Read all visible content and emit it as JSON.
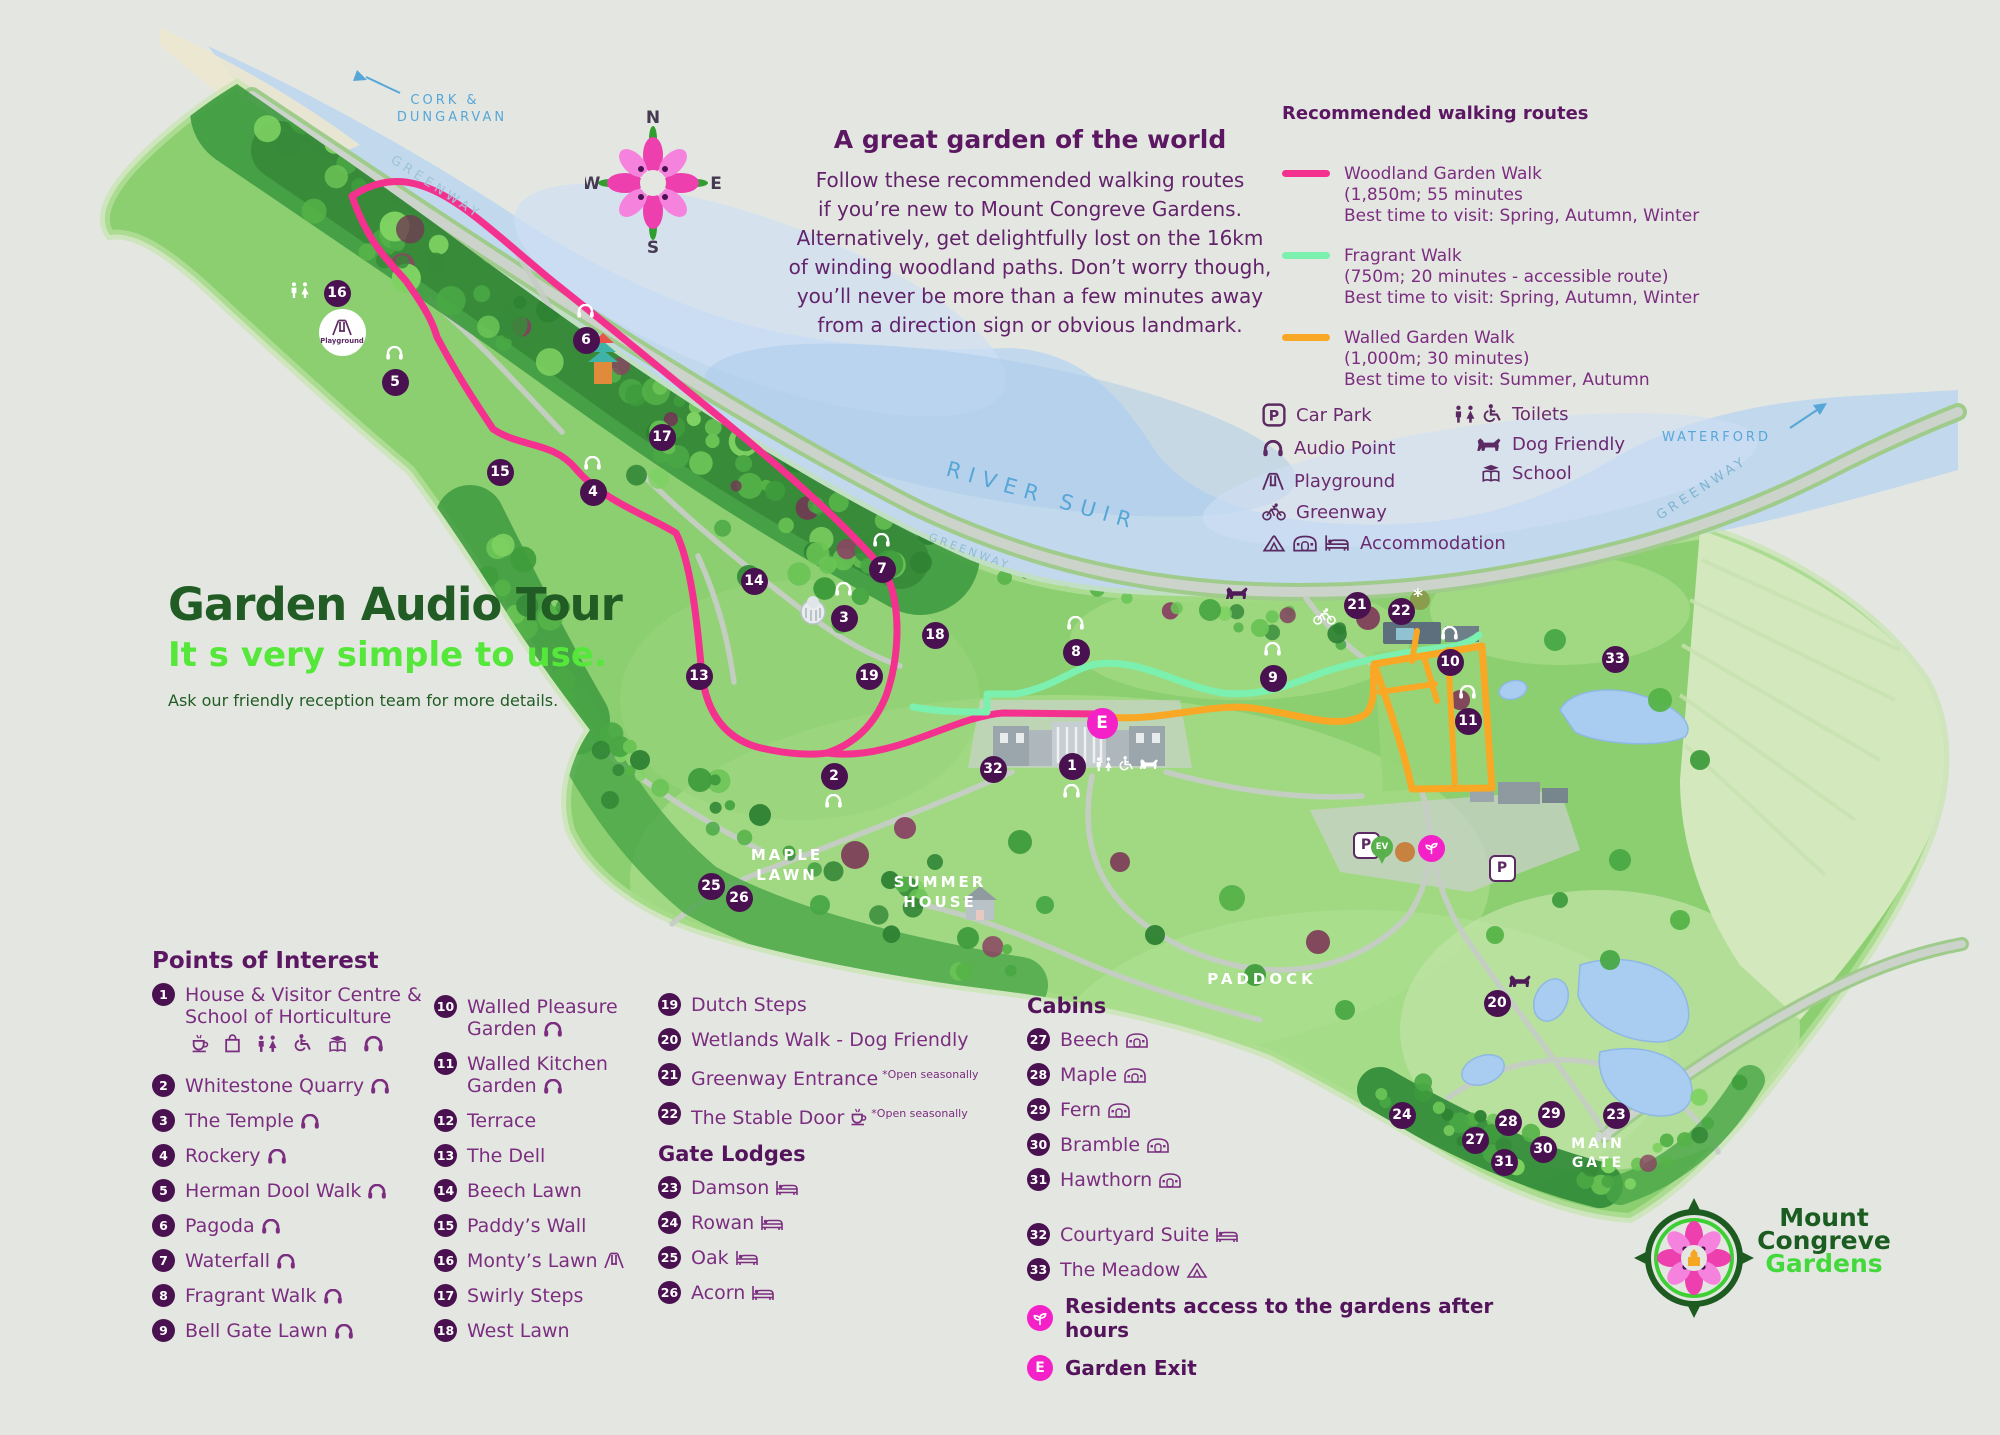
{
  "colors": {
    "marker_purple": "#4a1150",
    "text_purple": "#7b2d80",
    "heading_purple": "#5c1762",
    "magenta": "#f321c7",
    "pink_route": "#f5318f",
    "mint_route": "#7bf0af",
    "orange_route": "#f9a825",
    "dark_green": "#215c25",
    "bright_green": "#55e83a",
    "blue_label": "#57a6d8"
  },
  "header": {
    "title": "A great garden of the world",
    "intro_lines": [
      "Follow these recommended walking routes",
      "if you’re new to Mount Congreve Gardens.",
      "Alternatively, get delightfully lost on the 16km",
      "of winding woodland paths. Don’t worry though,",
      "you’ll never be more than a few minutes away",
      "from a direction sign or obvious landmark."
    ]
  },
  "compass": {
    "n": "N",
    "e": "E",
    "s": "S",
    "w": "W"
  },
  "routes_legend": {
    "title": "Recommended walking routes",
    "routes": [
      {
        "name": "Woodland Garden Walk",
        "detail": "(1,850m; 55 minutes",
        "best": "Best time to visit: Spring, Autumn, Winter",
        "color": "#f5318f"
      },
      {
        "name": "Fragrant Walk",
        "detail": "(750m; 20 minutes - accessible route)",
        "best": "Best time to visit: Spring, Autumn, Winter",
        "color": "#7bf0af"
      },
      {
        "name": "Walled Garden Walk",
        "detail": "(1,000m; 30 minutes)",
        "best": "Best time to visit: Summer, Autumn",
        "color": "#f9a825"
      }
    ]
  },
  "icons_legend": {
    "col1": [
      {
        "icon": "carpark",
        "label": "Car Park"
      },
      {
        "icon": "audio",
        "label": "Audio Point"
      },
      {
        "icon": "playground",
        "label": "Playground"
      },
      {
        "icon": "greenway-bike",
        "label": "Greenway"
      },
      {
        "icon": "tent,pod,bed",
        "label": "Accommodation"
      }
    ],
    "col2": [
      {
        "icon": "toilets,wheelchair",
        "label": "Toilets"
      },
      {
        "icon": "dog",
        "label": "Dog Friendly"
      },
      {
        "icon": "school",
        "label": "School"
      }
    ]
  },
  "audio_tour": {
    "title": "Garden Audio Tour",
    "subtitle": "It s very simple to use.",
    "note": "Ask our friendly reception team for more details."
  },
  "poi": {
    "title": "Points of Interest",
    "col1": [
      {
        "n": "1",
        "label": "House & Visitor Centre & School of Horticulture",
        "icons_below": [
          "cafe",
          "shop",
          "toilets",
          "wheelchair",
          "school",
          "audio"
        ]
      },
      {
        "n": "2",
        "label": "Whitestone Quarry",
        "icons": [
          "audio"
        ]
      },
      {
        "n": "3",
        "label": "The Temple",
        "icons": [
          "audio"
        ]
      },
      {
        "n": "4",
        "label": "Rockery",
        "icons": [
          "audio"
        ]
      },
      {
        "n": "5",
        "label": "Herman Dool Walk",
        "icons": [
          "audio"
        ]
      },
      {
        "n": "6",
        "label": "Pagoda",
        "icons": [
          "audio"
        ]
      },
      {
        "n": "7",
        "label": "Waterfall",
        "icons": [
          "audio"
        ]
      },
      {
        "n": "8",
        "label": "Fragrant Walk",
        "icons": [
          "audio"
        ]
      },
      {
        "n": "9",
        "label": "Bell Gate Lawn",
        "icons": [
          "audio"
        ]
      }
    ],
    "col2": [
      {
        "n": "10",
        "label": "Walled Pleasure Garden",
        "icons": [
          "audio"
        ]
      },
      {
        "n": "11",
        "label": "Walled Kitchen Garden",
        "icons": [
          "audio"
        ]
      },
      {
        "n": "12",
        "label": "Terrace"
      },
      {
        "n": "13",
        "label": "The Dell"
      },
      {
        "n": "14",
        "label": "Beech Lawn"
      },
      {
        "n": "15",
        "label": "Paddy’s Wall"
      },
      {
        "n": "16",
        "label": "Monty’s Lawn",
        "icons": [
          "playground"
        ]
      },
      {
        "n": "17",
        "label": "Swirly Steps"
      },
      {
        "n": "18",
        "label": "West Lawn"
      }
    ],
    "col3": [
      {
        "n": "19",
        "label": "Dutch Steps"
      },
      {
        "n": "20",
        "label": "Wetlands Walk - Dog Friendly"
      },
      {
        "n": "21",
        "label": "Greenway Entrance",
        "note": "*Open seasonally"
      },
      {
        "n": "22",
        "label": "The Stable Door",
        "icons": [
          "cafe"
        ],
        "note": "*Open seasonally"
      }
    ],
    "gate_lodges": {
      "title": "Gate Lodges",
      "items": [
        {
          "n": "23",
          "label": "Damson",
          "icons": [
            "bed"
          ]
        },
        {
          "n": "24",
          "label": "Rowan",
          "icons": [
            "bed"
          ]
        },
        {
          "n": "25",
          "label": "Oak",
          "icons": [
            "bed"
          ]
        },
        {
          "n": "26",
          "label": "Acorn",
          "icons": [
            "bed"
          ]
        }
      ]
    },
    "cabins": {
      "title": "Cabins",
      "items": [
        {
          "n": "27",
          "label": "Beech",
          "icons": [
            "pod"
          ]
        },
        {
          "n": "28",
          "label": "Maple",
          "icons": [
            "pod"
          ]
        },
        {
          "n": "29",
          "label": "Fern",
          "icons": [
            "pod"
          ]
        },
        {
          "n": "30",
          "label": "Bramble",
          "icons": [
            "pod"
          ]
        },
        {
          "n": "31",
          "label": "Hawthorn",
          "icons": [
            "pod"
          ]
        }
      ]
    },
    "extras": [
      {
        "n": "32",
        "label": "Courtyard Suite",
        "icons": [
          "bed"
        ]
      },
      {
        "n": "33",
        "label": "The Meadow",
        "icons": [
          "tent"
        ]
      }
    ],
    "residents_note": "Residents access to the gardens after hours",
    "garden_exit": {
      "badge": "E",
      "label": "Garden Exit"
    }
  },
  "map_labels": {
    "cork1": "CORK &",
    "cork2": "DUNGARVAN",
    "greenway_nw": "GREENWAY",
    "greenway_mid": "GREENWAY",
    "greenway_e": "GREENWAY",
    "river": "RIVER SUIR",
    "waterford": "WATERFORD",
    "maple1": "MAPLE",
    "maple2": "LAWN",
    "summer1": "SUMMER",
    "summer2": "HOUSE",
    "paddock": "PADDOCK",
    "main1": "MAIN",
    "main2": "GATE"
  },
  "map_markers": [
    {
      "n": "1",
      "x": 1072,
      "y": 766,
      "audio": "below"
    },
    {
      "n": "2",
      "x": 834,
      "y": 776,
      "audio": "below"
    },
    {
      "n": "3",
      "x": 844,
      "y": 618,
      "audio": "above"
    },
    {
      "n": "4",
      "x": 593,
      "y": 492,
      "audio": "above"
    },
    {
      "n": "5",
      "x": 395,
      "y": 382,
      "audio": "above"
    },
    {
      "n": "6",
      "x": 586,
      "y": 340,
      "audio": "above"
    },
    {
      "n": "7",
      "x": 882,
      "y": 569,
      "audio": "above"
    },
    {
      "n": "8",
      "x": 1076,
      "y": 652,
      "audio": "above"
    },
    {
      "n": "9",
      "x": 1273,
      "y": 678,
      "audio": "above"
    },
    {
      "n": "10",
      "x": 1450,
      "y": 662,
      "audio": "above"
    },
    {
      "n": "11",
      "x": 1468,
      "y": 721,
      "audio": "above"
    },
    {
      "n": "13",
      "x": 699,
      "y": 676
    },
    {
      "n": "14",
      "x": 754,
      "y": 581
    },
    {
      "n": "15",
      "x": 500,
      "y": 472
    },
    {
      "n": "16",
      "x": 337,
      "y": 293
    },
    {
      "n": "17",
      "x": 662,
      "y": 437
    },
    {
      "n": "18",
      "x": 935,
      "y": 635
    },
    {
      "n": "19",
      "x": 869,
      "y": 676
    },
    {
      "n": "20",
      "x": 1497,
      "y": 1003
    },
    {
      "n": "21",
      "x": 1357,
      "y": 605
    },
    {
      "n": "22",
      "x": 1401,
      "y": 611,
      "asterisk": true
    },
    {
      "n": "23",
      "x": 1616,
      "y": 1115
    },
    {
      "n": "24",
      "x": 1402,
      "y": 1115
    },
    {
      "n": "25",
      "x": 711,
      "y": 886
    },
    {
      "n": "26",
      "x": 739,
      "y": 898
    },
    {
      "n": "27",
      "x": 1475,
      "y": 1140
    },
    {
      "n": "28",
      "x": 1508,
      "y": 1122
    },
    {
      "n": "29",
      "x": 1551,
      "y": 1114
    },
    {
      "n": "30",
      "x": 1543,
      "y": 1149
    },
    {
      "n": "31",
      "x": 1504,
      "y": 1162
    },
    {
      "n": "32",
      "x": 993,
      "y": 769
    },
    {
      "n": "33",
      "x": 1615,
      "y": 659
    }
  ],
  "map_badges": {
    "exit": {
      "label": "E",
      "x": 1102,
      "y": 723
    },
    "residents": {
      "x": 1431,
      "y": 848
    },
    "car_parks": [
      {
        "label": "P",
        "x": 1364,
        "y": 843
      },
      {
        "label": "P",
        "x": 1500,
        "y": 866
      }
    ],
    "ev": {
      "label": "EV",
      "x": 1382,
      "y": 862
    },
    "toilets_white": {
      "x": 300,
      "y": 291
    },
    "playground_badge": {
      "label": "Playground",
      "x": 342,
      "y": 332
    },
    "dogs": [
      {
        "x": 1237,
        "y": 592
      },
      {
        "x": 1520,
        "y": 980
      }
    ],
    "bicycle": {
      "x": 1324,
      "y": 616
    },
    "visitor_icon_row": {
      "x": 1094,
      "y": 756
    }
  },
  "logo": {
    "line1": "Mount",
    "line2": "Congreve",
    "line3": "Gardens"
  }
}
